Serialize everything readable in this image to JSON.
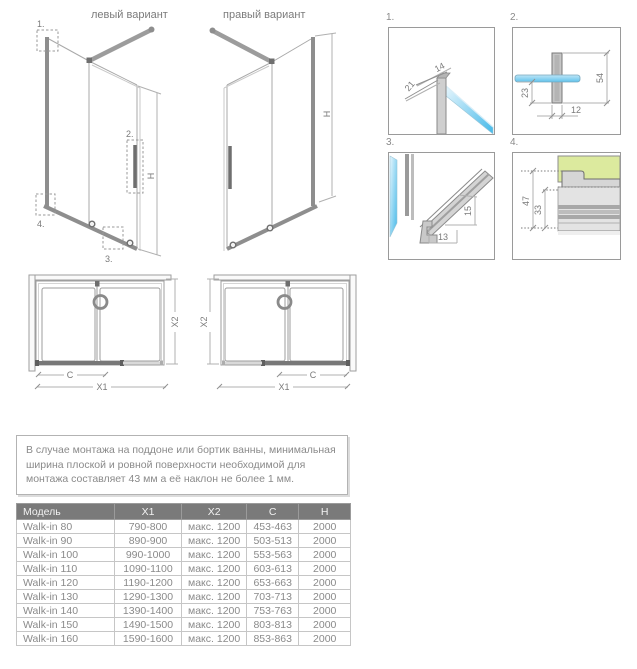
{
  "colors": {
    "line_gray": "#9e9e9e",
    "profile_gray": "#8e8e8e",
    "dark_gray": "#6f6f6f",
    "glass_blue_light": "#e7f6fd",
    "glass_blue_dark": "#45b9e9",
    "green_fill": "#dcea9e",
    "table_header_bg": "#7a7a7a",
    "table_header_text": "#f2f2f2",
    "body_text_gray": "#8a8a8a"
  },
  "variants": {
    "left": {
      "title": "левый вариант",
      "h_dim": "H",
      "callouts": {
        "c1": "1.",
        "c2": "2.",
        "c3": "3.",
        "c4": "4."
      }
    },
    "right": {
      "title": "правый вариант",
      "h_dim": "H"
    }
  },
  "plan_views": {
    "x1": "X1",
    "x2": "X2",
    "c": "C"
  },
  "details": {
    "d1": {
      "label": "1.",
      "dim_a": "21",
      "dim_b": "14"
    },
    "d2": {
      "label": "2.",
      "dim_a": "54",
      "dim_b": "23",
      "dim_c": "12"
    },
    "d3": {
      "label": "3.",
      "dim_a": "15",
      "dim_b": "13"
    },
    "d4": {
      "label": "4.",
      "dim_a": "47",
      "dim_b": "33"
    }
  },
  "note": {
    "text": "В случае монтажа на поддоне или бортик ванны, минимальная ширина плоской и ровной поверхности необходимой для монтажа составляет 43 мм а её наклон не более 1 мм."
  },
  "spec_table": {
    "headers": [
      "Модель",
      "X1",
      "X2",
      "C",
      "H"
    ],
    "rows": [
      [
        "Walk-in 80",
        "790-800",
        "макс. 1200",
        "453-463",
        "2000"
      ],
      [
        "Walk-in 90",
        "890-900",
        "макс. 1200",
        "503-513",
        "2000"
      ],
      [
        "Walk-in 100",
        "990-1000",
        "макс. 1200",
        "553-563",
        "2000"
      ],
      [
        "Walk-in 110",
        "1090-1100",
        "макс. 1200",
        "603-613",
        "2000"
      ],
      [
        "Walk-in 120",
        "1190-1200",
        "макс. 1200",
        "653-663",
        "2000"
      ],
      [
        "Walk-in 130",
        "1290-1300",
        "макс. 1200",
        "703-713",
        "2000"
      ],
      [
        "Walk-in 140",
        "1390-1400",
        "макс. 1200",
        "753-763",
        "2000"
      ],
      [
        "Walk-in 150",
        "1490-1500",
        "макс. 1200",
        "803-813",
        "2000"
      ],
      [
        "Walk-in 160",
        "1590-1600",
        "макс. 1200",
        "853-863",
        "2000"
      ]
    ]
  }
}
